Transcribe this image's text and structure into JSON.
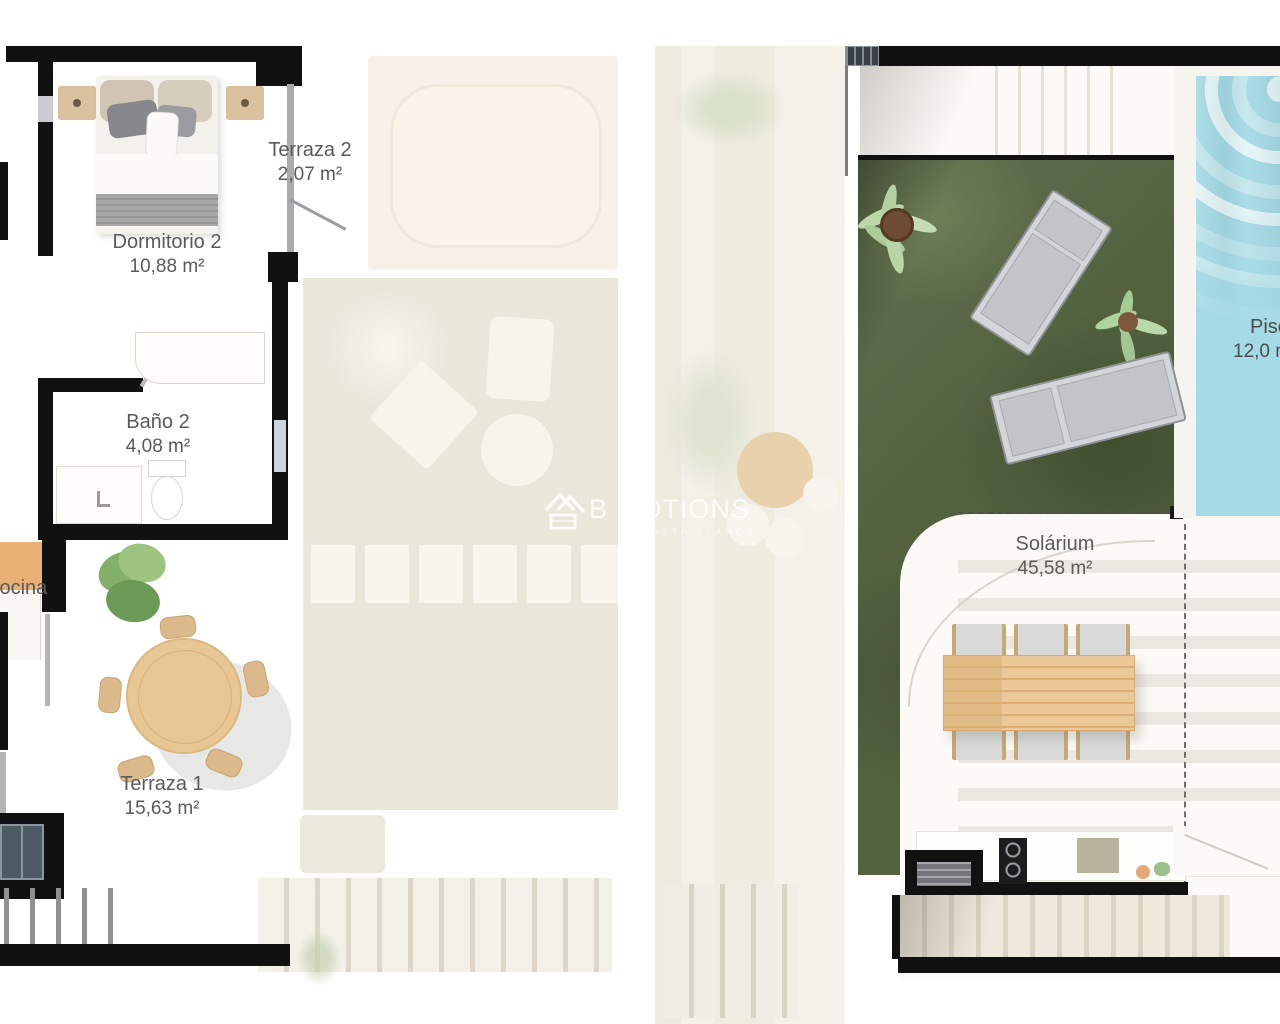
{
  "left_plan": {
    "rooms": [
      {
        "id": "terraza2",
        "label": "Terraza 2",
        "area": "2,07 m²"
      },
      {
        "id": "dormitorio2",
        "label": "Dormitorio 2",
        "area": "10,88 m²"
      },
      {
        "id": "bano2",
        "label": "Baño 2",
        "area": "4,08 m²"
      },
      {
        "id": "cocina",
        "label": "Cocina",
        "area": ""
      },
      {
        "id": "terraza1",
        "label": "Terraza 1",
        "area": "15,63 m²"
      }
    ]
  },
  "right_plan": {
    "rooms": [
      {
        "id": "solarium",
        "label": "Solárium",
        "area": "45,58 m²"
      },
      {
        "id": "piscina",
        "label": "Piscina",
        "area": "12,0 m²"
      }
    ]
  },
  "watermark": {
    "logo": "house-icon",
    "text_left": "B",
    "text_right": "MOTIONS",
    "subtitle": "COSTA BLANCA"
  },
  "colors": {
    "wall": "#111111",
    "grass": "#52613e",
    "pool": "#a4dae5",
    "wood": "#ecc797",
    "faded_beige": "#e9e6da",
    "label_text": "#5a5a5a"
  }
}
